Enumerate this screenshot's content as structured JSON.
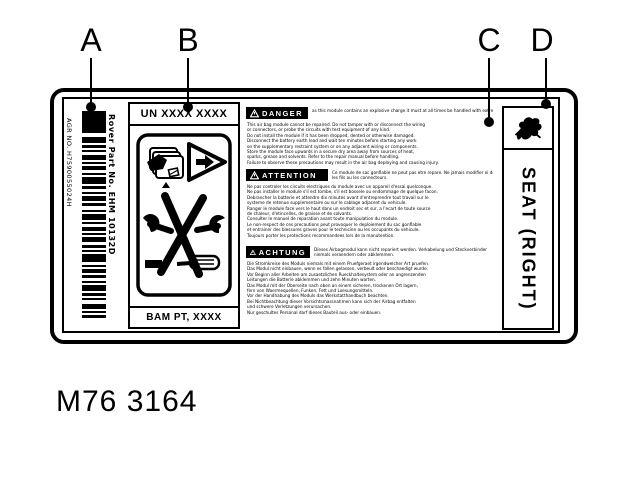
{
  "figure": {
    "caption": "M76 3164",
    "callouts": [
      {
        "letter": "A",
        "target": "barcode"
      },
      {
        "letter": "B",
        "target": "un-code-box"
      },
      {
        "letter": "C",
        "target": "warning-text-block"
      },
      {
        "letter": "D",
        "target": "logo-icon"
      }
    ]
  },
  "colors": {
    "ink": "#000000",
    "paper": "#ffffff"
  },
  "label": {
    "barcode": {
      "agr_text": "AGR NO. H7590055024H",
      "part_text": "Rover Part No. EHM 10132D",
      "pattern": [
        22,
        4,
        6,
        2,
        3,
        2,
        2,
        3,
        5,
        2,
        2,
        2,
        4,
        3,
        2,
        2,
        7,
        2,
        3,
        3,
        2,
        2,
        5,
        2,
        3,
        4,
        2,
        2,
        6,
        2,
        2,
        3,
        4,
        2,
        2,
        2,
        5,
        3,
        3,
        2,
        2,
        2,
        8,
        3,
        2,
        2,
        4,
        2,
        3,
        3,
        2,
        2,
        6,
        2,
        3,
        2,
        2,
        4,
        5,
        2,
        2,
        2,
        3,
        3,
        7,
        2,
        2,
        2,
        4,
        3,
        2,
        2,
        5,
        2,
        6,
        3
      ]
    },
    "middle": {
      "un_code": "UN XXXX XXXX",
      "bam_code": "BAM PT, XXXX",
      "icons": [
        "airbag-module-icon",
        "warning-triangle-icon",
        "no-tools-icon"
      ]
    },
    "warnings": [
      {
        "lang": "en",
        "header": "DANGER",
        "side_lines": [
          "as this module contains an explosive charge it must at all times be handled with extreme care"
        ],
        "body_lines": [
          "This air bag module cannot be repaired. Do not tamper with or disconnect the wiring",
          "or connectors, or probe the circuits with test equipment of any kind.",
          "Do not install the module if it has been dropped, dented or otherwise damaged.",
          "Disconnect the battery earth lead and wait ten minutes before starting any work",
          "on the supplementary restraint system or on any adjacent wiring or components.",
          "Store the module face upwards in a secure dry area away from sources of heat,",
          "sparks, grease and solvents. Refer to the repair manual before handling.",
          "Failure to observe these precautions may result in the air bag deploying and causing injury."
        ]
      },
      {
        "lang": "fr",
        "header": "ATTENTION",
        "side_lines": [
          "Ce module de sac gonflable ne peut pas etre repare. Ne jamais modifier ni debrancher",
          "les fils ou les connecteurs."
        ],
        "body_lines": [
          "Ne pas controler les circuits electriques du module avec un appareil d'essai quelconque.",
          "Ne pas installer le module s'il est tombe, s'il est bossele ou endommage de quelque facon.",
          "Debrancher la batterie et attendre dix minutes avant d'entreprendre tout travail sur le",
          "systeme de retenue supplementaire ou sur le cablage adjacent du vehicule.",
          "Ranger le module face vers le haut dans un endroit sec et sur, a l'ecart de toute source",
          "de chaleur, d'etincelles, de graisse et de solvants.",
          "Consulter le manuel de reparation avant toute manipulation du module.",
          "Le non-respect de ces precautions peut provoquer le deploiement du sac gonflable",
          "et entrainer des blessures graves pour le technicien ou les occupants du vehicule.",
          "Toujours porter les protections recommandees lors de la manutention."
        ]
      },
      {
        "lang": "de",
        "header": "ACHTUNG",
        "side_lines": [
          "Dieses Airbagmodul kann nicht repariert werden. Verkabelung und Steckverbinder",
          "niemals veraendern oder abklemmen."
        ],
        "body_lines": [
          "Die Stromkreise des Moduls niemals mit einem Pruefgeraet irgendwelcher Art pruefen.",
          "Das Modul nicht einbauen, wenn es fallen gelassen, verbeult oder beschaedigt wurde.",
          "Vor Beginn aller Arbeiten am zusaetzlichen Rueckhaltesystem oder an angrenzenden",
          "Leitungen die Batterie abklemmen und zehn Minuten warten.",
          "Das Modul mit der Oberseite nach oben an einem sicheren, trockenen Ort lagern,",
          "fern von Waermequellen, Funken, Fett und Loesungsmitteln.",
          "Vor der Handhabung des Moduls das Werkstatthandbuch beachten.",
          "Bei Nichtbeachtung dieser Vorsichtsmassnahmen kann sich der Airbag entfalten",
          "und schwere Verletzungen verursachen.",
          "Nur geschultes Personal darf dieses Bauteil aus- oder einbauen."
        ]
      }
    ],
    "side_panel": {
      "seat_text": "SEAT (RIGHT)"
    }
  }
}
